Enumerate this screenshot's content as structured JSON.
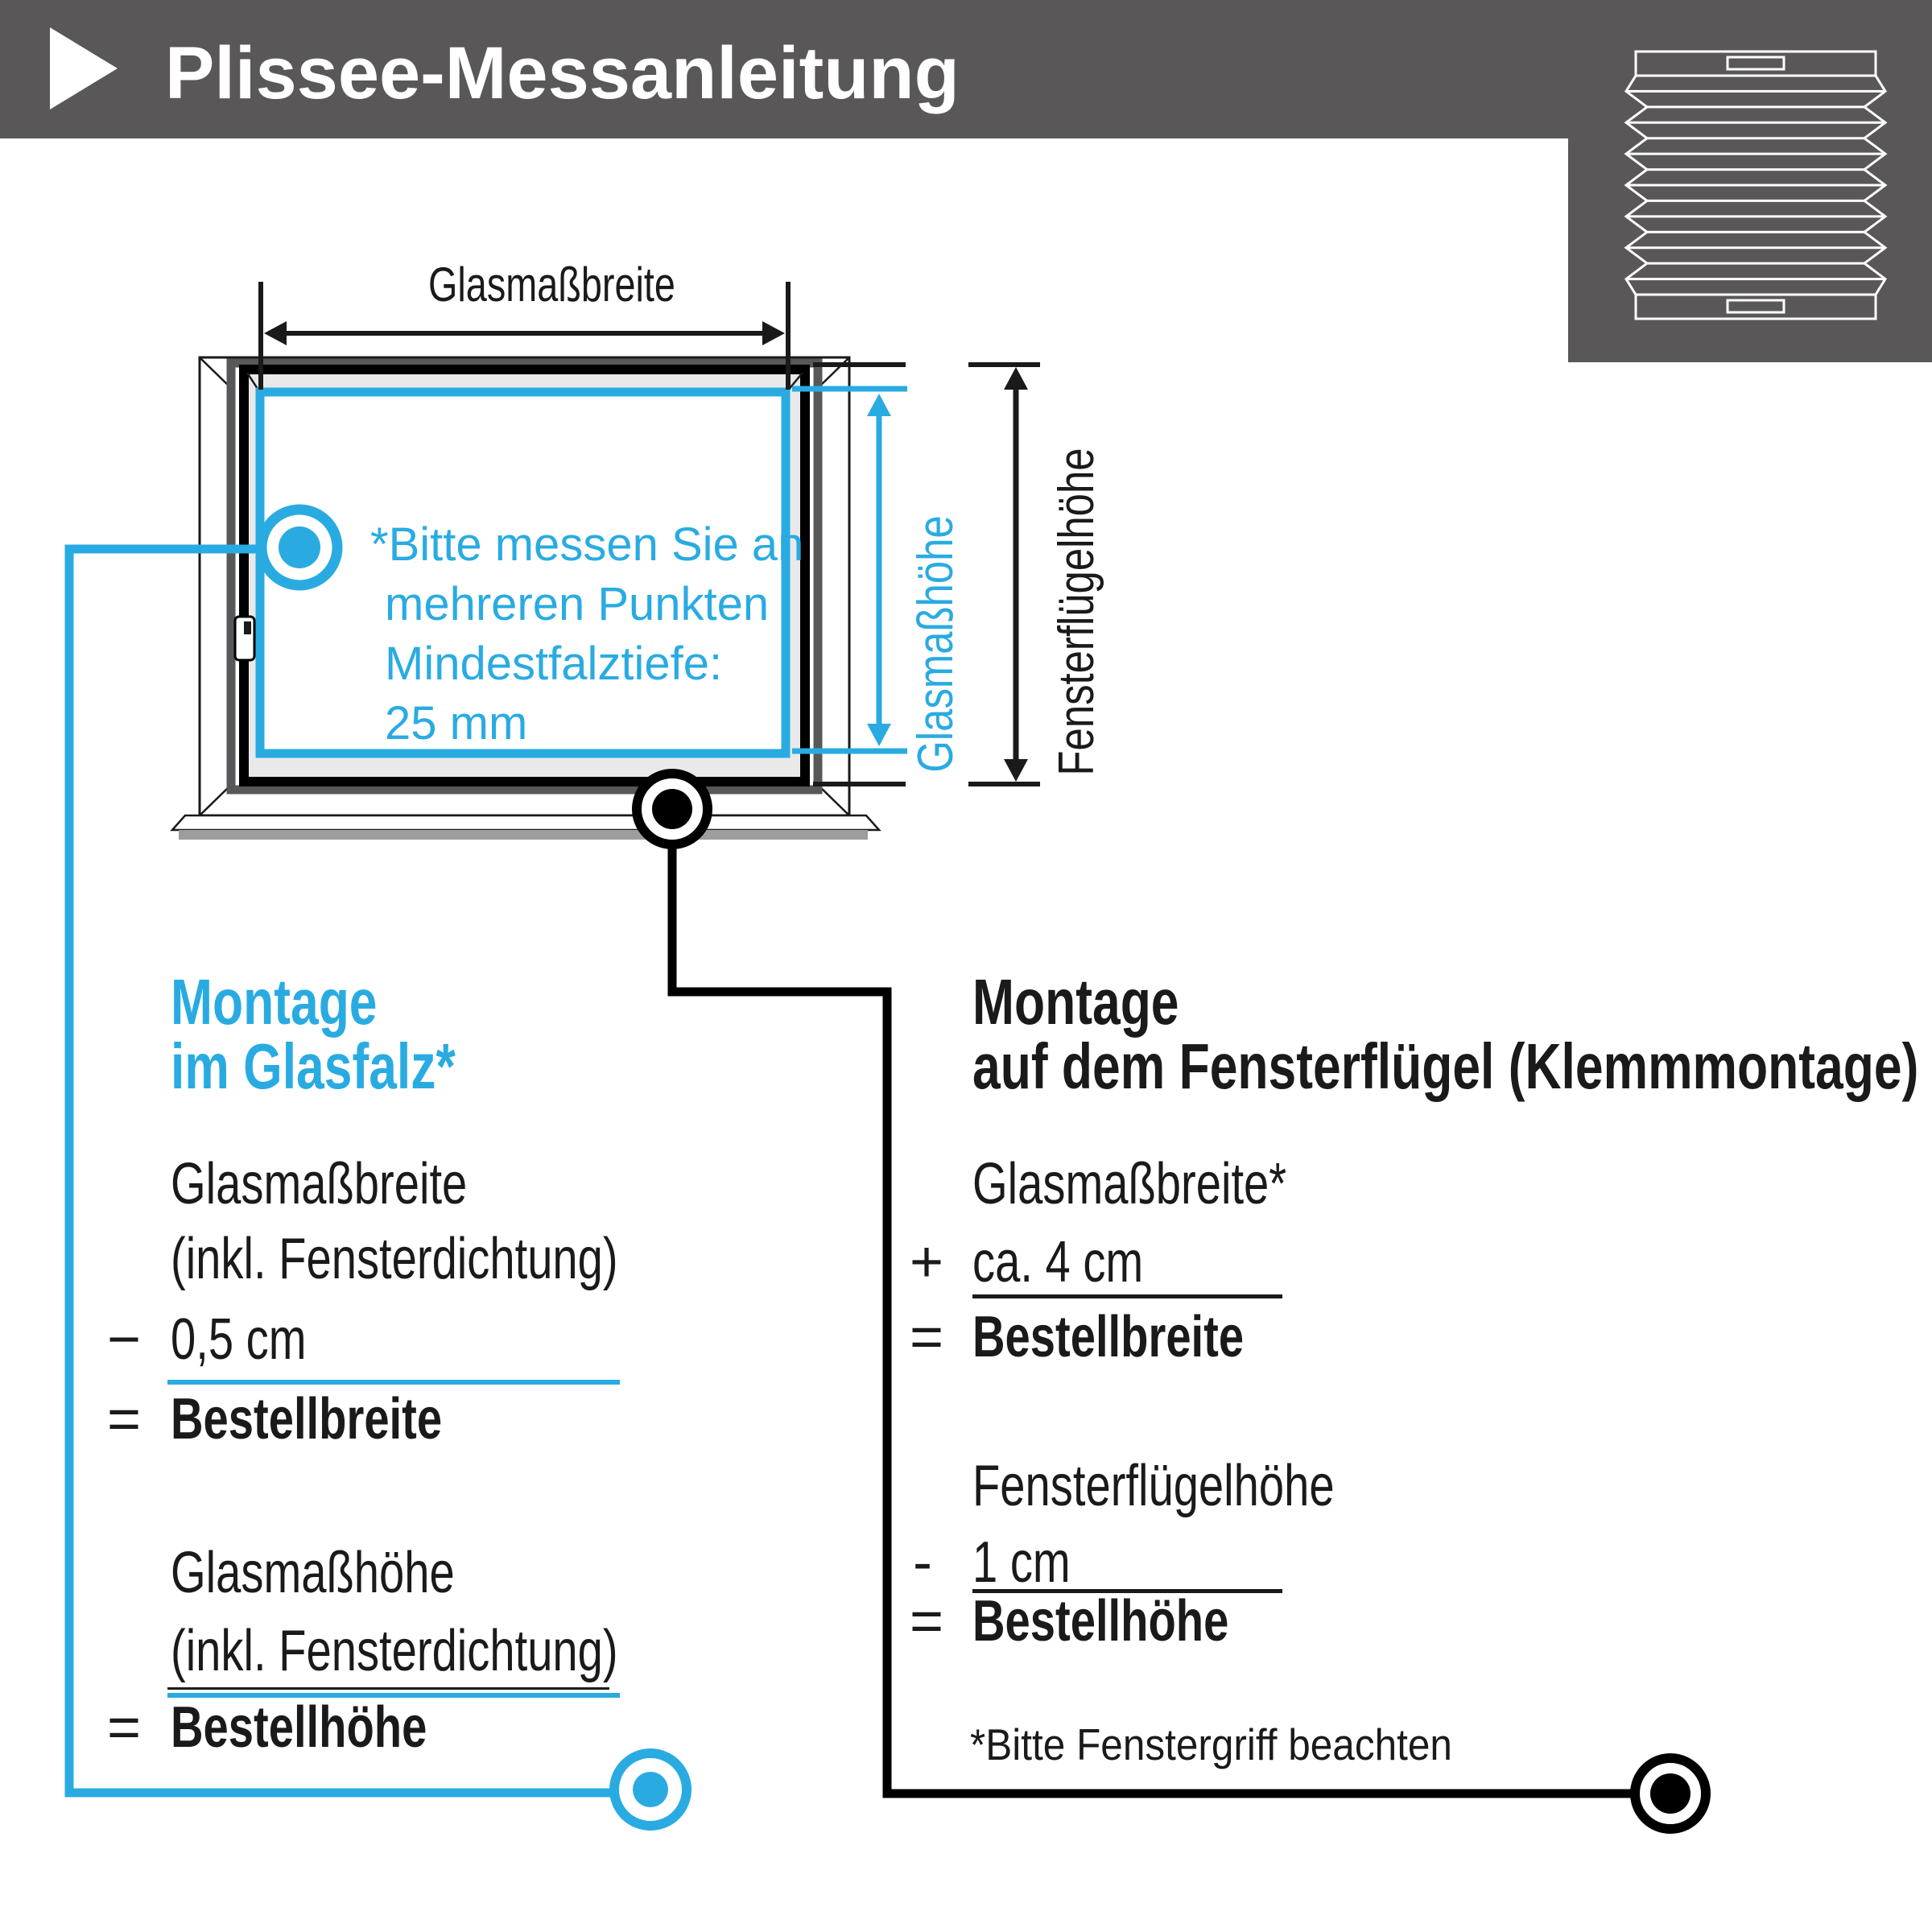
{
  "header": {
    "title": "Plissee-Messanleitung"
  },
  "colors": {
    "header_bg": "#595757",
    "accent_blue": "#29ABE2",
    "text_dark": "#1a1a1a",
    "frame_gray": "#58585A",
    "glazing_gray": "#E9E9E9",
    "sill_shadow": "#9D9D9C"
  },
  "icons": {
    "play_triangle": "play-triangle-icon",
    "pleated_blind": "pleated-blind-icon"
  },
  "diagram": {
    "width_label": "Glasmaßbreite",
    "glass_height_label": "Glasmaßhöhe",
    "sash_height_label": "Fensterflügelhöhe",
    "note_lines": [
      "*Bitte messen Sie an",
      "mehreren Punkten",
      "Mindestfalztiefe:",
      "25 mm"
    ]
  },
  "left_section": {
    "heading_line1": "Montage",
    "heading_line2": "im Glasfalz*",
    "width_calc": {
      "line1": "Glasmaßbreite",
      "line2": "(inkl. Fensterdichtung)",
      "op3": "−",
      "line3": "0,5 cm",
      "op4": "=",
      "result": "Bestellbreite"
    },
    "height_calc": {
      "line1": "Glasmaßhöhe",
      "line2": "(inkl. Fensterdichtung)",
      "op": "=",
      "result": "Bestellhöhe"
    }
  },
  "right_section": {
    "heading_line1": "Montage",
    "heading_line2": "auf dem Fensterflügel (Klemmmontage)",
    "width_calc": {
      "line1": "Glasmaßbreite*",
      "op2": "+",
      "line2": "ca. 4 cm",
      "op3": "=",
      "result": "Bestellbreite"
    },
    "height_calc": {
      "line1": "Fensterflügelhöhe",
      "op2": "-",
      "line2": "1 cm",
      "op3": "=",
      "result": "Bestellhöhe"
    },
    "footnote": "*Bitte Fenstergriff beachten"
  }
}
